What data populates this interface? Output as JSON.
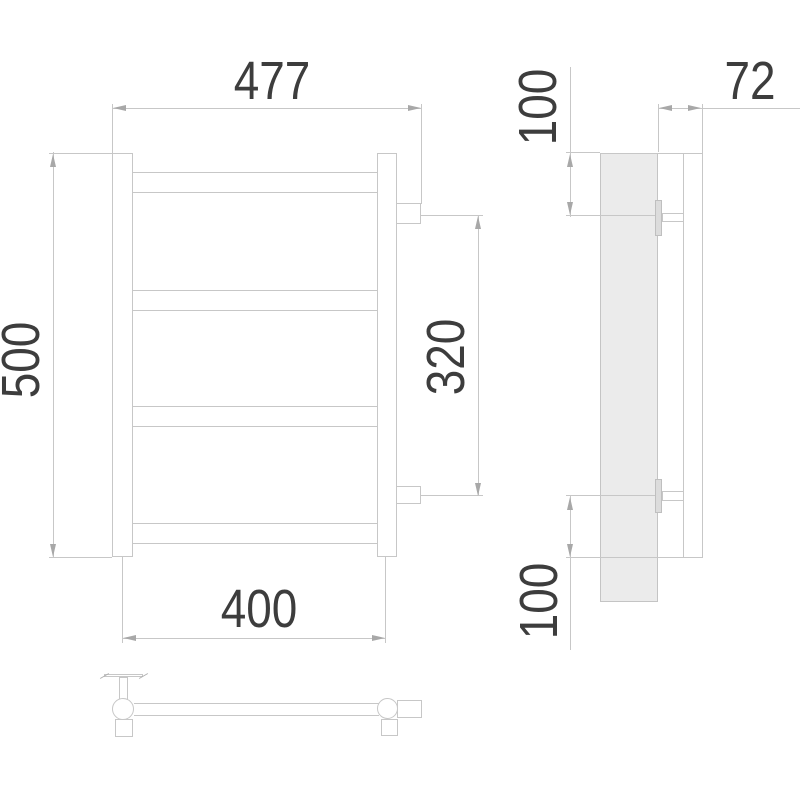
{
  "meta": {
    "type": "technical-drawing",
    "subject": "ladder towel rail, three orthographic views (front, side, plan)"
  },
  "palette": {
    "background": "#ffffff",
    "line": "#c7c7c7",
    "text": "#3d3d3d",
    "arrow": "#a8a8a8",
    "tube_fill": "#ebebeb",
    "flange_fill": "#dcdcdc"
  },
  "dimensions": {
    "overall_width": "477",
    "height": "500",
    "connection_spacing": "320",
    "mount_width": "400",
    "depth": "72",
    "top_offset": "100",
    "bottom_offset": "100"
  },
  "views": {
    "front": {
      "rungs": 4,
      "posts": 2,
      "side_fittings": 2
    },
    "side": {
      "bracket": 1,
      "vertical_tube": 1,
      "pipe_connectors": 2
    },
    "top": {
      "valve": 1,
      "collectors": 2,
      "wall_fitting": 1
    }
  }
}
